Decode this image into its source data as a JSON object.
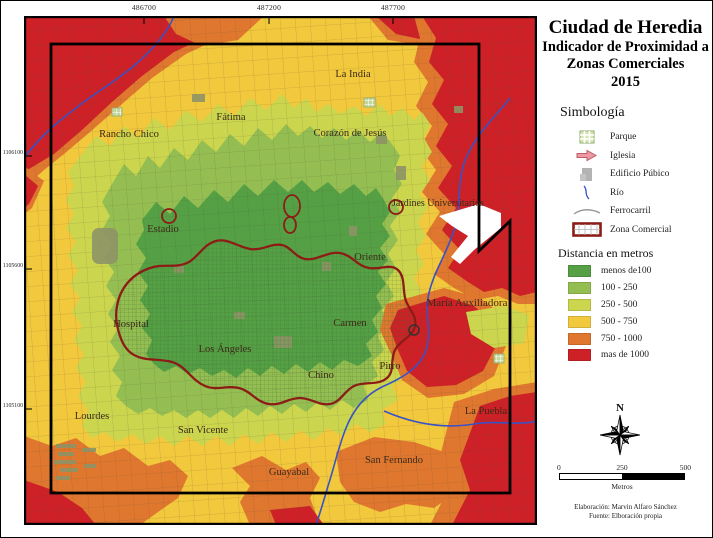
{
  "title": {
    "line1": "Ciudad de Heredia",
    "line2": "Indicador de Proximidad a",
    "line3": "Zonas Comerciales",
    "line4": "2015"
  },
  "symbology": {
    "heading": "Simbología",
    "items": [
      {
        "label": "Parque",
        "icon": "park-icon"
      },
      {
        "label": "Iglesia",
        "icon": "church-icon"
      },
      {
        "label": "Edificio Púbico",
        "icon": "public-building-icon"
      },
      {
        "label": "Río",
        "icon": "river-icon"
      },
      {
        "label": "Ferrocarril",
        "icon": "railroad-icon"
      },
      {
        "label": "Zona Comercial",
        "icon": "commercial-zone-icon"
      }
    ]
  },
  "distance_legend": {
    "heading": "Distancia en metros",
    "classes": [
      {
        "label": "menos de100",
        "color": "#55a045"
      },
      {
        "label": "100 - 250",
        "color": "#94be52"
      },
      {
        "label": "250 - 500",
        "color": "#ccd54e"
      },
      {
        "label": "500 - 750",
        "color": "#f2c83d"
      },
      {
        "label": "750 - 1000",
        "color": "#e0772f"
      },
      {
        "label": "mas de 1000",
        "color": "#cd2127"
      }
    ]
  },
  "map": {
    "grid_coordinates": {
      "top": [
        "486700",
        "487200",
        "487700"
      ],
      "left": [
        "1106100",
        "1105600",
        "1105100"
      ]
    },
    "places": {
      "la_india": "La India",
      "fatima": "Fátima",
      "corazon_de_jesus": "Corazón de Jesús",
      "rancho_chico": "Rancho Chico",
      "jardines_universitarios": "Jardines Universitarios",
      "estadio": "Estadio",
      "oriente": "Oriente",
      "maria_auxiliadora": "María Auxiliadora",
      "hospital": "Hospital",
      "carmen": "Carmen",
      "los_angeles": "Los Ángeles",
      "pirro": "Pirro",
      "chino": "Chino",
      "lourdes": "Lourdes",
      "san_vicente": "San Vicente",
      "la_puebla": "La Puebla",
      "guayabal": "Guayabal",
      "san_fernando": "San Fernando"
    }
  },
  "map_colors": {
    "green": "#55a045",
    "light_green": "#94be52",
    "yellow_green": "#ccd54e",
    "yellow": "#f2c83d",
    "orange": "#e0772f",
    "red": "#cd2127",
    "commercial_outline": "#8c1c16",
    "river": "#3a52c4"
  },
  "compass": {
    "north_label": "N"
  },
  "scale_bar": {
    "ticks": [
      "0",
      "250",
      "500"
    ],
    "unit_label": "Metros"
  },
  "credits": {
    "line1": "Elaboración: Marvin Alfaro Sánchez",
    "line2": "Fuente: Elboración propia"
  }
}
